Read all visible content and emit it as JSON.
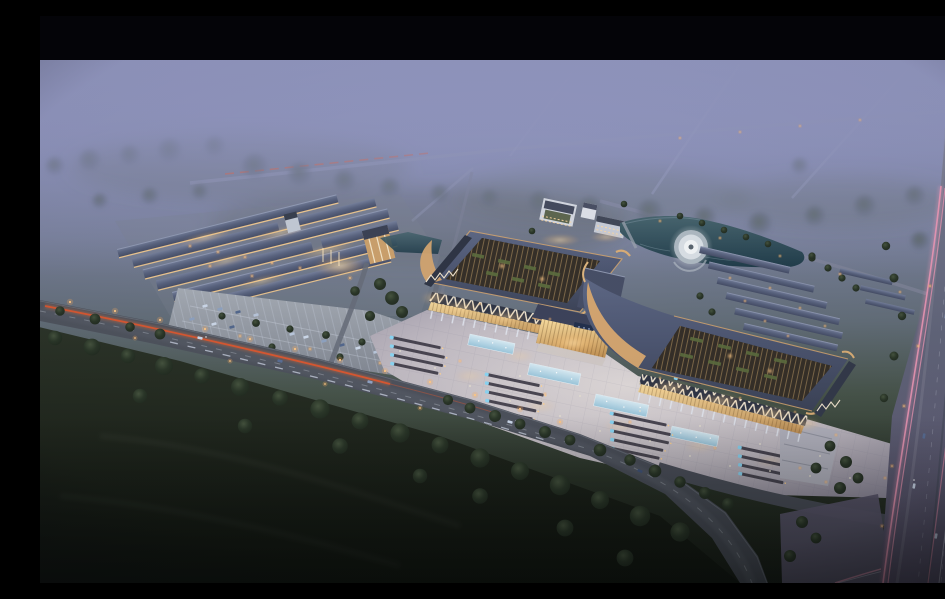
{
  "meta": {
    "type": "architectural aerial rendering",
    "time_of_day": "dusk",
    "alt": "Dusk aerial rendering of a large market campus: two pavilion exhibition halls with open lattice roofs and upturned copper eaves joined by a lit entrance hall, a bright festival plaza with stall rows and glowing pools, a warehouse market complex with parking to the west, a pond with a circular fountain, row outbuildings, misty farmland with faint roads beyond, a boulevard with red and white light trails in front, and a highway with pink light trails on the right, letterboxed with a black bar at top."
  },
  "palette": {
    "letterbox": "#040408",
    "sky-top": "#9195bd",
    "mist": "#9297c0",
    "field-dark": "#10140f",
    "tree-dark": "#222c21",
    "tree-hazy": "#5a665e",
    "road-asphalt": "#474b56",
    "highway-asphalt": "#62667b",
    "plaza-light": "#ded8d8",
    "lot-gray": "#a6acb5",
    "roof-blue": "#4c5570",
    "eave-tan": "#d2a470",
    "warm-light": "#ffd9a0",
    "glass-warm": "#f7db9e",
    "pool-blue": "#d9eef7",
    "stall-dark": "#403c48",
    "stall-blue": "#8ad4f2",
    "trail-red": "#e2582f",
    "trail-pink": "#f59ab8",
    "trail-white": "#dfe7f8",
    "pond-teal": "#213d4b",
    "fountain-white": "#f2f5f7"
  },
  "scene": {
    "regions": [
      "black letterbox bar",
      "hazy twilight farmland with faint diagonal roads",
      "wooded buffer bands",
      "warehouse market complex with lit facades and parking lot",
      "twin pavilion halls with lattice roofs and upturned eaves",
      "central entrance hall with warm glass",
      "festival plaza with market stall rows and glowing blue pools",
      "pond with circular fountain",
      "white administration cluster",
      "row outbuildings",
      "boulevard with red and white vehicle light trails",
      "highway with pink light trails",
      "dark meadow foreground with tree clumps"
    ]
  }
}
